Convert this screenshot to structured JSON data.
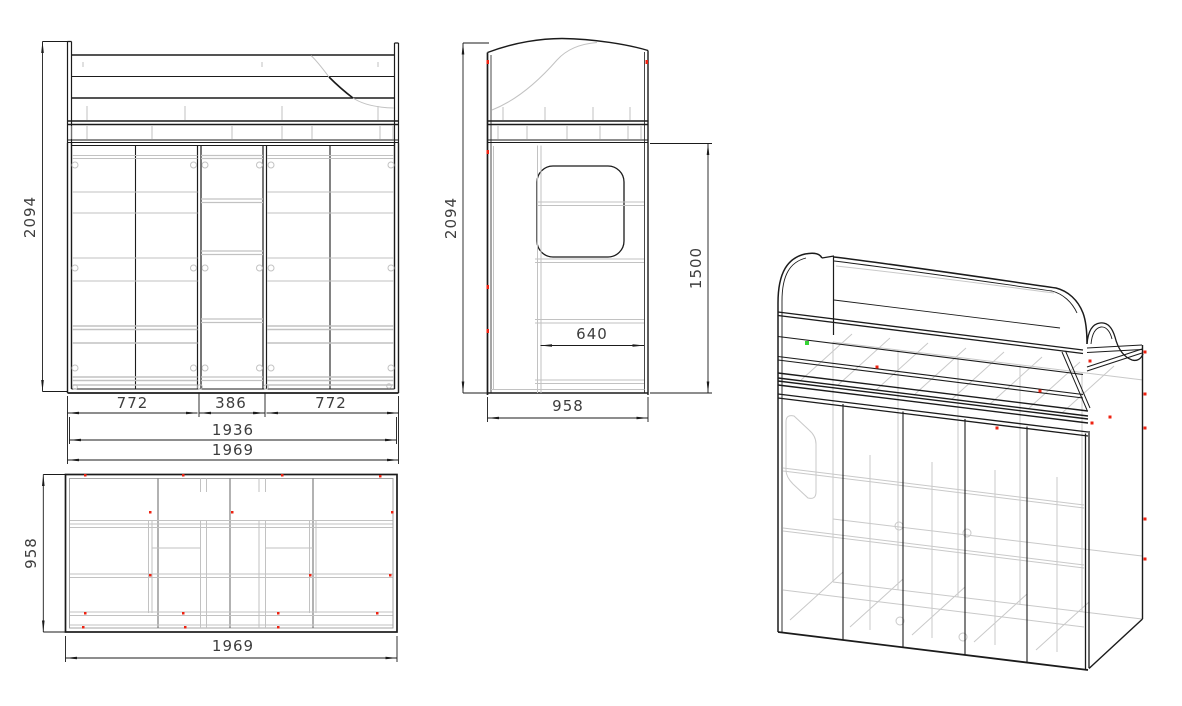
{
  "drawing": {
    "type": "furniture-technical-drawing",
    "background": "#ffffff",
    "line_color": "#1b1b1b",
    "hidden_line_color": "#c2c2c2",
    "fastener_marker_color": "#ee2211",
    "highlight_marker_color": "#35d435",
    "views": {
      "front": {
        "label": "front-view",
        "height_mm": "2094",
        "section_widths_mm": [
          "772",
          "386",
          "772"
        ],
        "inner_width_mm": "1936",
        "overall_width_mm": "1969"
      },
      "side": {
        "label": "side-view",
        "height_mm": "2094",
        "clearance_height_mm": "1500",
        "opening_width_mm": "640",
        "overall_depth_mm": "958"
      },
      "top": {
        "label": "top-view",
        "overall_depth_mm": "958",
        "overall_width_mm": "1969"
      },
      "isometric": {
        "label": "isometric-view"
      }
    }
  }
}
